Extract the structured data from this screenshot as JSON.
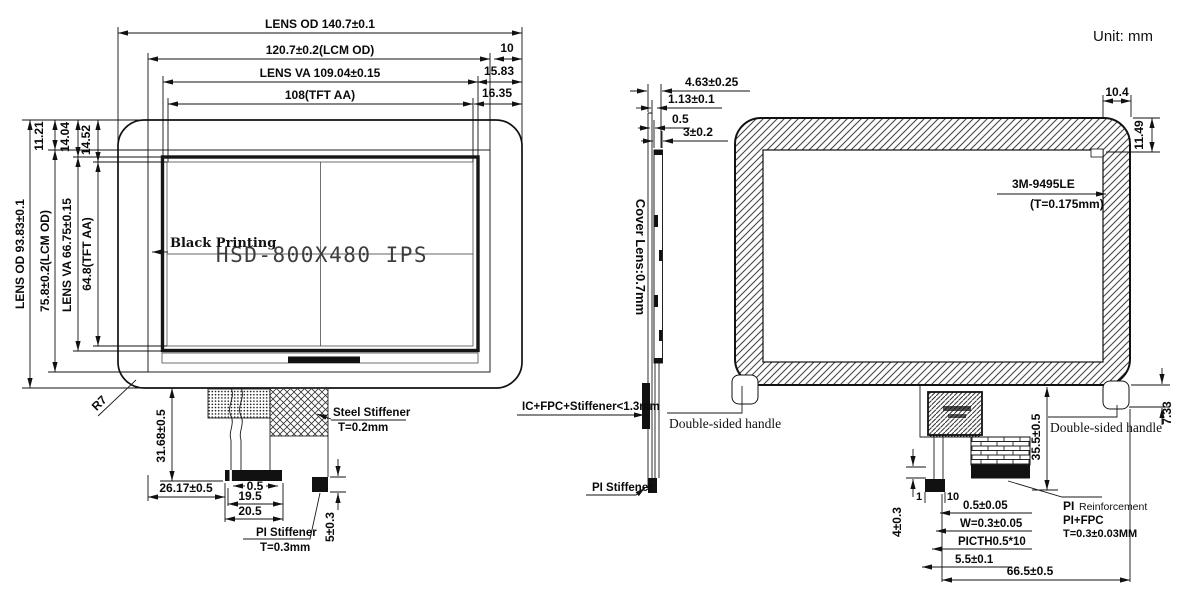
{
  "unit_label": "Unit: mm",
  "front_view": {
    "watermark": "HSD-800X480 IPS",
    "black_printing": "Black Printing",
    "corner_radius": "R7",
    "top_dims": {
      "lens_od": "LENS OD 140.7±0.1",
      "lcm_od": "120.7±0.2(LCM OD)",
      "lens_va": "LENS VA 109.04±0.15",
      "tft_aa": "108(TFT AA)",
      "offset_right_1": "10",
      "offset_right_2": "15.83",
      "offset_right_3": "16.35"
    },
    "left_dims": {
      "lens_od": "LENS OD 93.83±0.1",
      "lcm_od": "75.8±0.2(LCM OD)",
      "lens_va": "LENS VA 66.75±0.15",
      "tft_aa": "64.8(TFT AA)",
      "offset_top_1": "11.21",
      "offset_top_2": "14.04",
      "offset_top_3": "14.52"
    },
    "bottom_dims": {
      "fpc_length": "31.68±0.5",
      "fpc_offset": "26.17±0.5",
      "slot": "0.5",
      "contact_width": "19.5",
      "connector_width": "20.5",
      "stiffener_height": "5±0.3"
    },
    "labels": {
      "steel_stiffener": "Steel Stiffener",
      "steel_stiffener_t": "T=0.2mm",
      "pi_stiffener": "PI Stiffener",
      "pi_stiffener_t": "T=0.3mm"
    }
  },
  "side_view": {
    "dims": {
      "total_thickness": "4.63±0.25",
      "lcm_thickness": "1.13±0.1",
      "gap": "0.5",
      "module_thickness": "3±0.2"
    },
    "cover_lens": "Cover Lens:0.7mm",
    "ic_fpc": "IC+FPC+Stiffener<1.3mm",
    "pi_stiffener": "PI Stiffener"
  },
  "back_view": {
    "dims": {
      "border_width": "10.4",
      "border_height": "11.49",
      "handle_drop": "7.33",
      "fpc_height": "35.5±0.5",
      "fold": "4±0.3",
      "pin_first": "1",
      "pin_last": "10",
      "pin_width": "0.5±0.05",
      "trace_width": "W=0.3±0.05",
      "pitch": "PICTH0.5*10",
      "tail_offset": "5.5±0.1",
      "fpc_center": "66.5±0.5"
    },
    "labels": {
      "tape": "3M-9495LE",
      "tape_t": "(T=0.175mm)",
      "handle_left": "Double-sided handle",
      "handle_right": "Double-sided handle",
      "pi_reinforcement_1": "PI",
      "pi_reinforcement_2": "Reinforcement",
      "pi_fpc": "PI+FPC",
      "pi_t": "T=0.3±0.03MM"
    }
  }
}
